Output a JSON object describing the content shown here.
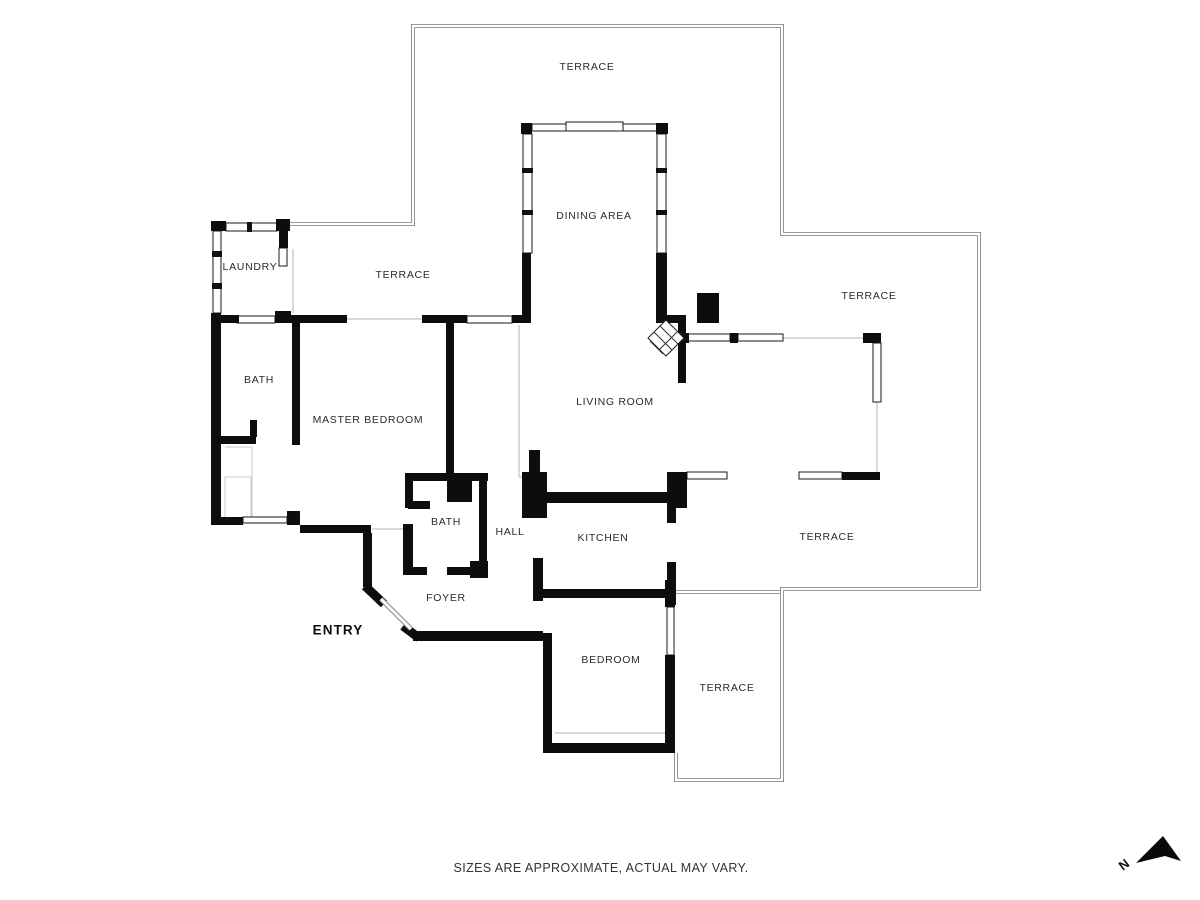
{
  "plan": {
    "rooms": [
      {
        "id": "terrace-top",
        "label": "TERRACE",
        "x": 587,
        "y": 67,
        "emphasis": false
      },
      {
        "id": "dining-area",
        "label": "DINING AREA",
        "x": 594,
        "y": 216,
        "emphasis": false
      },
      {
        "id": "laundry",
        "label": "LAUNDRY",
        "x": 250,
        "y": 267,
        "emphasis": false
      },
      {
        "id": "terrace-left",
        "label": "TERRACE",
        "x": 403,
        "y": 275,
        "emphasis": false
      },
      {
        "id": "terrace-right",
        "label": "TERRACE",
        "x": 869,
        "y": 296,
        "emphasis": false
      },
      {
        "id": "bath-master",
        "label": "BATH",
        "x": 259,
        "y": 380,
        "emphasis": false
      },
      {
        "id": "living-room",
        "label": "LIVING ROOM",
        "x": 615,
        "y": 402,
        "emphasis": false
      },
      {
        "id": "master-bedroom",
        "label": "MASTER BEDROOM",
        "x": 368,
        "y": 420,
        "emphasis": false
      },
      {
        "id": "bath-hall",
        "label": "BATH",
        "x": 446,
        "y": 522,
        "emphasis": false
      },
      {
        "id": "hall",
        "label": "HALL",
        "x": 510,
        "y": 532,
        "emphasis": false
      },
      {
        "id": "kitchen",
        "label": "KITCHEN",
        "x": 603,
        "y": 538,
        "emphasis": false
      },
      {
        "id": "terrace-southeast",
        "label": "TERRACE",
        "x": 827,
        "y": 537,
        "emphasis": false
      },
      {
        "id": "foyer",
        "label": "FOYER",
        "x": 446,
        "y": 598,
        "emphasis": false
      },
      {
        "id": "entry",
        "label": "ENTRY",
        "x": 338,
        "y": 630,
        "emphasis": true
      },
      {
        "id": "bedroom",
        "label": "BEDROOM",
        "x": 611,
        "y": 660,
        "emphasis": false
      },
      {
        "id": "terrace-bottom",
        "label": "TERRACE",
        "x": 727,
        "y": 688,
        "emphasis": false
      }
    ],
    "compass": {
      "label": "N"
    },
    "footnote": "SIZES ARE APPROXIMATE, ACTUAL MAY VARY.",
    "colors": {
      "wall": "#0d0d0d",
      "outline": "#787878",
      "thin": "#b3b3b3",
      "background": "#ffffff"
    }
  }
}
